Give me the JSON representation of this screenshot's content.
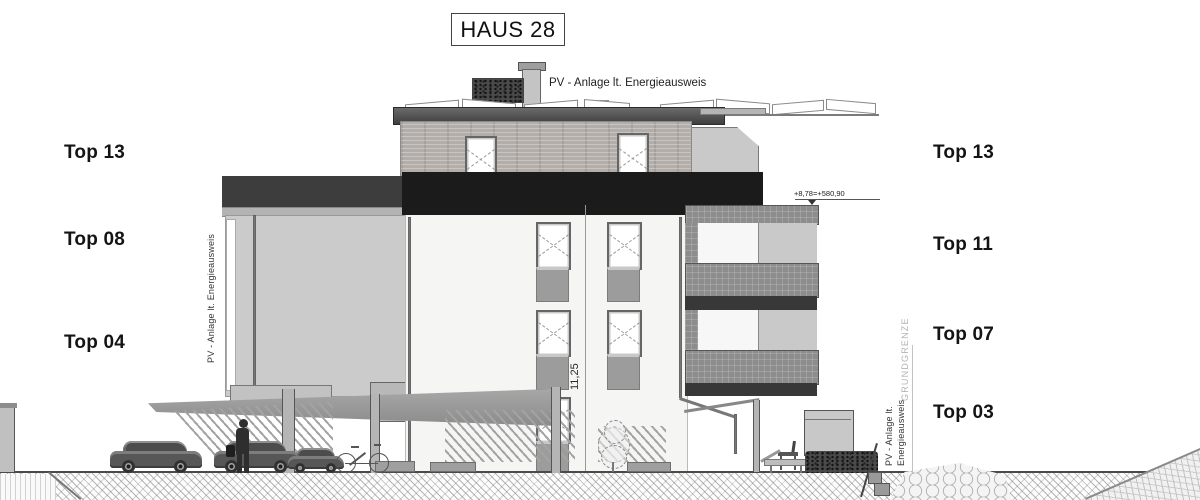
{
  "title": "HAUS 28",
  "labels": {
    "left": [
      "Top 13",
      "Top 08",
      "Top 04"
    ],
    "right": [
      "Top 13",
      "Top 11",
      "Top 07",
      "Top 03"
    ]
  },
  "annotations": {
    "pv_top": "PV - Anlage lt. Energieausweis",
    "pv_left_vertical": "PV - Anlage lt. Energieausweis",
    "pv_right_line1": "PV - Anlage lt.",
    "pv_right_line2": "Energieausweis",
    "level_mark": "+8,78=+580,90",
    "dimension_height": "11,25",
    "boundary": "GRUNDGRENZE"
  },
  "palette": {
    "ink": "#141414",
    "band_dark": "#1b1b1b",
    "band_mid": "#3d3d3d",
    "facade_light": "#cbcbcb",
    "facade_white": "#f5f5f4",
    "mesh_gray": "#8d8d8d",
    "wood_gray": "#b3aeaa"
  }
}
